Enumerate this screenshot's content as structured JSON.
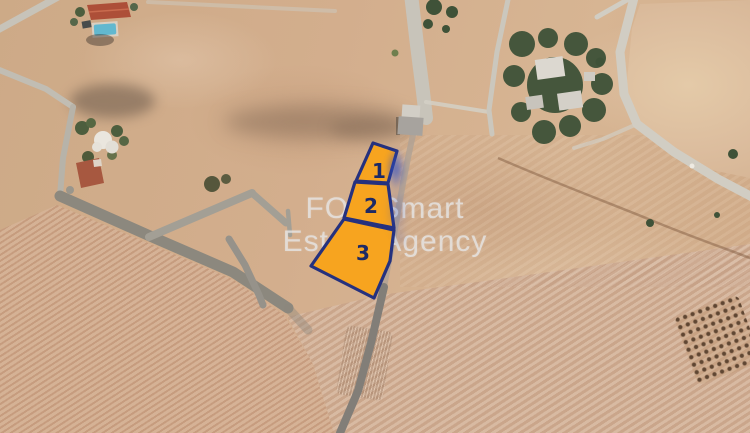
{
  "watermark": {
    "line1": "FOX Smart",
    "line2": "Estate Agency"
  },
  "plots": [
    {
      "id": "plot-1",
      "label": "1"
    },
    {
      "id": "plot-2",
      "label": "2"
    },
    {
      "id": "plot-3",
      "label": "3"
    }
  ],
  "colors": {
    "plot_fill": "#F7A41F",
    "plot_border": "#25317E",
    "plot_number": "#1D2A66",
    "watermark_text": "#E6E6E6",
    "terrain_base": "#D2AE8C",
    "road_light": "#CFCBC1",
    "road_dark": "#84807A",
    "tree_green": "#3F5238",
    "marker_blue_smear": "#2E4FC5",
    "pool_blue": "#62B8CF",
    "roof_red": "#AD4F38"
  },
  "map_features": [
    "satellite-terrain",
    "plowed-striped-field",
    "dirt-road-network",
    "residential-house-with-pool",
    "tree-clusters",
    "walled-compound",
    "olive-grove",
    "numbered-land-plots-overlay"
  ]
}
